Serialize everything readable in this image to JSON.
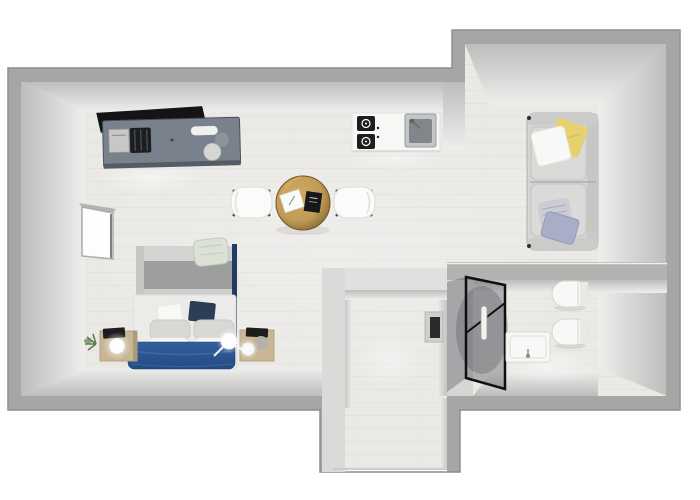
{
  "scene": {
    "type": "3d-floorplan-top-down-render",
    "canvas": {
      "width": 700,
      "height": 500
    }
  },
  "rooms": [
    "living-sleeping-area",
    "kitchen-area",
    "dining-area",
    "lounge-corner",
    "bathroom",
    "entry-vestibule"
  ],
  "furniture": [
    "tv-panel",
    "desk-sideboard",
    "laptop",
    "printer",
    "kitchen-counter",
    "cooktop",
    "kitchen-sink",
    "dining-table",
    "dining-chair-left",
    "dining-chair-right",
    "notepad",
    "black-book",
    "wall-bed-cabinet",
    "double-bed",
    "blue-duvet",
    "pillows",
    "draped-blanket",
    "nightstand-left",
    "nightstand-right",
    "sphere-lamp",
    "plant",
    "window",
    "sofa",
    "pillow-yellow",
    "pillow-white",
    "pillow-striped",
    "pillow-lavender",
    "shower-glass",
    "shower-handle",
    "bathroom-sink",
    "toilet",
    "bidet",
    "wall-niche-panel",
    "entry-opening"
  ],
  "colors": {
    "background": "#ffffff",
    "wall_outer": "#a6a6a4",
    "wall_outline": "#8e8e8c",
    "wall_partition": "#e0e0de",
    "face_dark": "#bdbdbb",
    "face_light": "#eeeeec",
    "floor": "#eae9e6",
    "floor_line": "#d9d8d5",
    "tv_black": "#141414",
    "desk_gray": "#79828c",
    "desk_gray_dark": "#555c66",
    "steel_light": "#c7c7c7",
    "appliance_black": "#1b1d20",
    "counter_white": "#f7f7f5",
    "cooktop_black": "#1e1e1e",
    "sink_steel": "#9fa3a6",
    "table_gold": "#c09a58",
    "table_gold_dark": "#7d5f2b",
    "chair_white": "#fbfbfa",
    "cabinet_light": "#d3d3d1",
    "cabinet_mid": "#9e9e9c",
    "duvet_blue": "#315f9e",
    "duvet_blue_dark": "#254c82",
    "pillow_navy": "#2c3d57",
    "pillow_gray": "#d8d8d4",
    "pillow_white": "#f8f8f6",
    "blanket_sage": "#dce1d6",
    "pole_navy": "#203c60",
    "wood_tan": "#c9b694",
    "plant_green": "#5c7a4e",
    "sofa_gray": "#d5d5d3",
    "sofa_line": "#aeaeac",
    "pillow_yellow": "#e6d16e",
    "pillow_lavender": "#a8adc8",
    "pillow_stripe": "#cbcdd4",
    "fixture_white": "#f8f8f6",
    "frame_black": "#0f0f0f",
    "shadow_dark": "#474c52",
    "niche_dark": "#2b2b2b"
  }
}
